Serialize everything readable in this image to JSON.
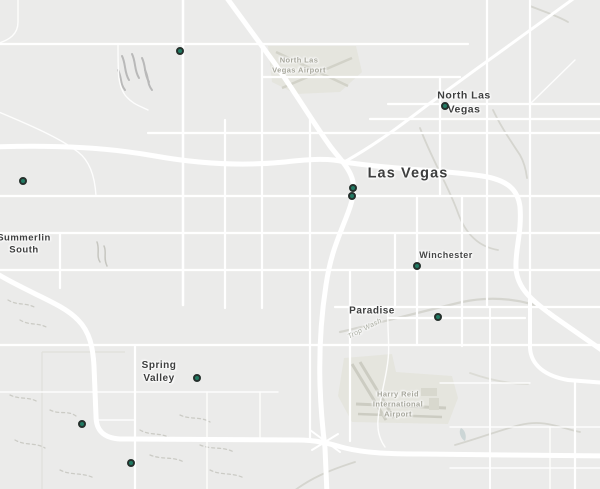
{
  "map": {
    "palette": {
      "background": "#ebebea",
      "road": "#ffffff",
      "airport_fill": "#e5e5de",
      "runway": "#d2d2c8",
      "wash_line": "#c9c9c3",
      "terrain_mark": "#b9b9b9",
      "water": "#ccd6d6",
      "city_label": "#3d3e3e",
      "airport_label": "#a6a69b",
      "marker_fill": "#217a63",
      "marker_border": "#25302c"
    },
    "labels": [
      {
        "id": "north-las-vegas-airport",
        "text": "North Las\nVegas Airport",
        "type": "airport"
      },
      {
        "id": "north-las-vegas",
        "text": "North Las\nVegas",
        "type": "city"
      },
      {
        "id": "las-vegas",
        "text": "Las Vegas",
        "type": "city-major"
      },
      {
        "id": "summerlin-south",
        "text": "Summerlin\nSouth",
        "type": "city"
      },
      {
        "id": "winchester",
        "text": "Winchester",
        "type": "city-small"
      },
      {
        "id": "paradise",
        "text": "Paradise",
        "type": "city"
      },
      {
        "id": "spring-valley",
        "text": "Spring\nValley",
        "type": "city"
      },
      {
        "id": "harry-reid-airport",
        "text": "Harry Reid\nInternational\nAirport",
        "type": "airport"
      },
      {
        "id": "trop-wash",
        "text": "Trop Wash",
        "type": "wash"
      }
    ],
    "markers": {
      "icon": "marker-dot-icon",
      "points": [
        {
          "x": 180,
          "y": 51
        },
        {
          "x": 445,
          "y": 106
        },
        {
          "x": 23,
          "y": 181
        },
        {
          "x": 353,
          "y": 188
        },
        {
          "x": 352,
          "y": 196
        },
        {
          "x": 417,
          "y": 266
        },
        {
          "x": 438,
          "y": 317
        },
        {
          "x": 197,
          "y": 378
        },
        {
          "x": 82,
          "y": 424
        },
        {
          "x": 131,
          "y": 463
        }
      ]
    }
  }
}
